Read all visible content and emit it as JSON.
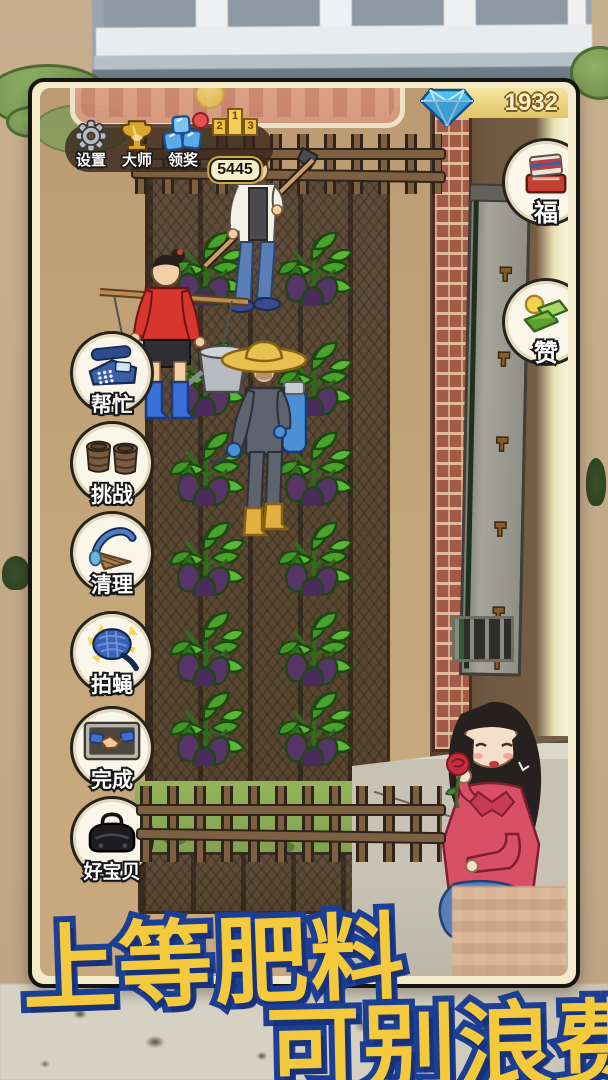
{
  "topbar": {
    "gems": "1932",
    "menu": [
      {
        "label": "设置",
        "icon": "gear-icon"
      },
      {
        "label": "大师",
        "icon": "trophy-icon"
      },
      {
        "label": "领奖",
        "icon": "crystal-icon",
        "badge": true
      }
    ],
    "podium": {
      "first": "1",
      "second": "2",
      "third": "3"
    },
    "score": "5445"
  },
  "left_menu": [
    {
      "label": "帮忙",
      "icon": "phone-icon"
    },
    {
      "label": "挑战",
      "icon": "barrels-icon"
    },
    {
      "label": "清理",
      "icon": "broom-icon"
    },
    {
      "label": "拍蝇",
      "icon": "fly-swatter-icon"
    },
    {
      "label": "完成",
      "icon": "handshake-icon"
    },
    {
      "label": "好宝贝",
      "icon": "bag-icon"
    }
  ],
  "right_menu": [
    {
      "label": "福",
      "icon": "gift-icon"
    },
    {
      "label": "赞",
      "icon": "money-icon"
    }
  ],
  "caption": {
    "line1": "上等肥料",
    "line2": "可别浪费"
  },
  "colors": {
    "caption_fill": "#f4c93c",
    "caption_stroke": "#1c3f96",
    "gold_bar": "#e2c465",
    "button_bg": "#faf6ea",
    "menu_bar_bg": "rgba(56,38,26,0.8)",
    "soil": "#5a4836",
    "eggplant": "#563468",
    "leaf": "#48a32c"
  }
}
